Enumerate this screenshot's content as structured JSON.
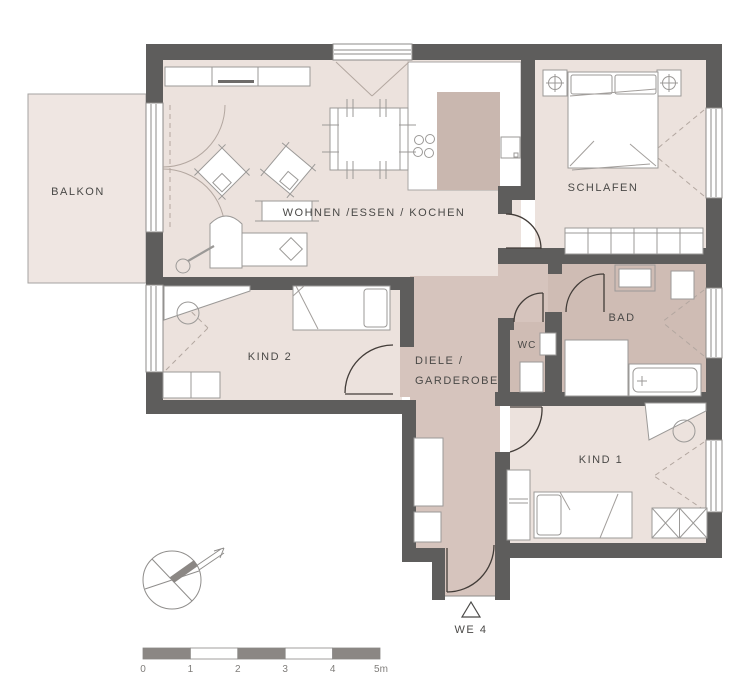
{
  "labels": {
    "balkon": "BALKON",
    "wohnen": "WOHNEN /ESSEN / KOCHEN",
    "schlafen": "SCHLAFEN",
    "kind2": "KIND 2",
    "diele1": "DIELE /",
    "diele2": "GARDEROBE",
    "wc": "WC",
    "bad": "BAD",
    "kind1": "KIND 1",
    "entrance": "WE 4"
  },
  "scale_bar": {
    "ticks": [
      "0",
      "1",
      "2",
      "3",
      "4",
      "5m"
    ]
  },
  "icons": {
    "north_arrow": "compass-north-arrow",
    "entrance_marker": "triangle-entrance-marker"
  },
  "colors": {
    "wall": "#5e5d5c",
    "floor": "#ece2dd",
    "balcony_floor": "#efe6e2",
    "corridor_floor": "#d6c4bd",
    "wet_room_floor": "#cfbcb4",
    "kitchen_island": "#c9b7af",
    "furniture_line": "#9b9997",
    "door_line": "#423c38",
    "text": "#4a4947"
  }
}
